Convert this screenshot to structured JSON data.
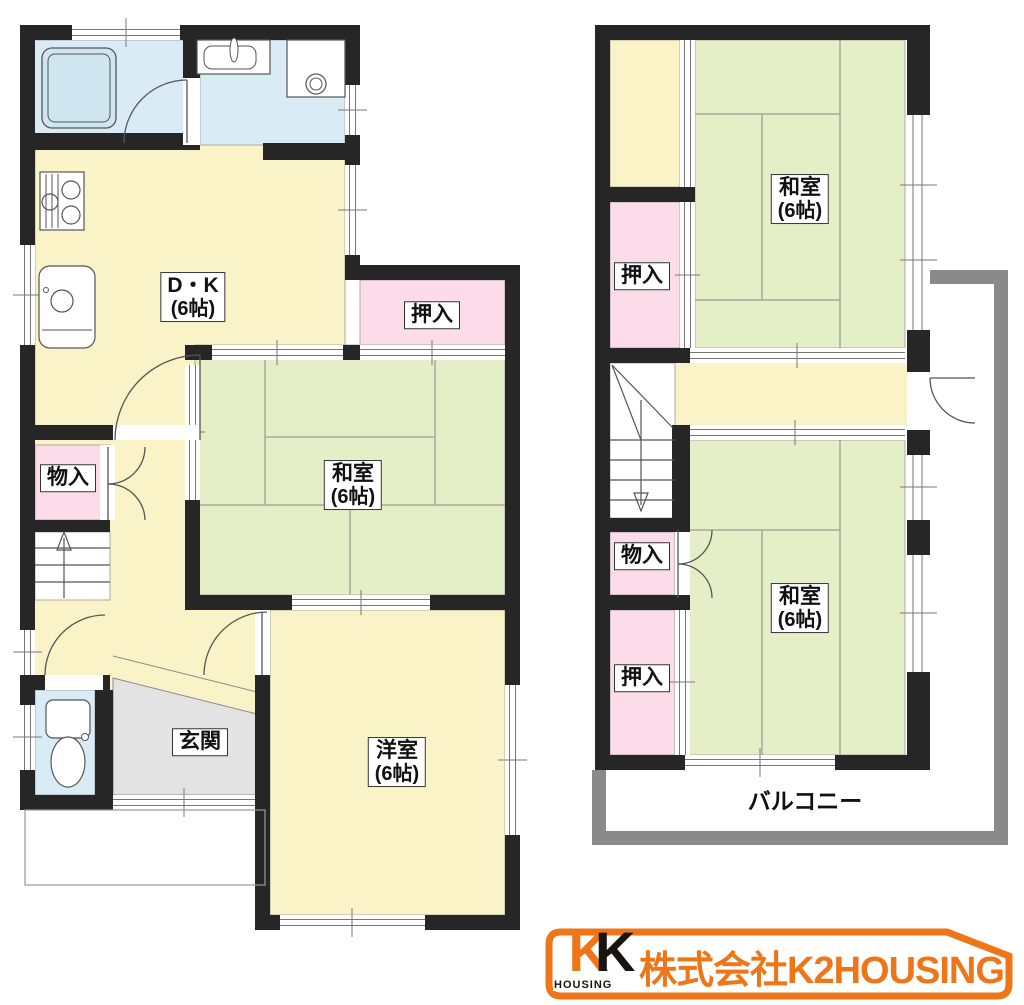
{
  "colors": {
    "room_yellow": "#FAF3C8",
    "tatami_green": "#E4EFC8",
    "closet_pink": "#FBDCE8",
    "wet_area_blue": "#D9EBF4",
    "genkan_gray": "#E3E3E3",
    "wall_black": "#262626",
    "balcony_gray": "#8A8A8A",
    "logo_orange": "#EE7518"
  },
  "floor1": {
    "rooms": {
      "dk": {
        "name": "D・K",
        "size": "(6帖)"
      },
      "oshiire": {
        "name": "押入"
      },
      "washitsu": {
        "name": "和室",
        "size": "(6帖)"
      },
      "monoire": {
        "name": "物入"
      },
      "genkan": {
        "name": "玄関"
      },
      "youshitsu": {
        "name": "洋室",
        "size": "(6帖)"
      }
    }
  },
  "floor2": {
    "rooms": {
      "washitsu_north": {
        "name": "和室",
        "size": "(6帖)"
      },
      "oshiire_north": {
        "name": "押入"
      },
      "monoire": {
        "name": "物入"
      },
      "oshiire_south": {
        "name": "押入"
      },
      "washitsu_south": {
        "name": "和室",
        "size": "(6帖)"
      },
      "balcony": {
        "name": "バルコニー"
      }
    }
  },
  "logo": {
    "mark_k1": "K",
    "mark_k2": "K",
    "mark_caption": "HOUSING",
    "company": "株式会社K2HOUSING"
  }
}
